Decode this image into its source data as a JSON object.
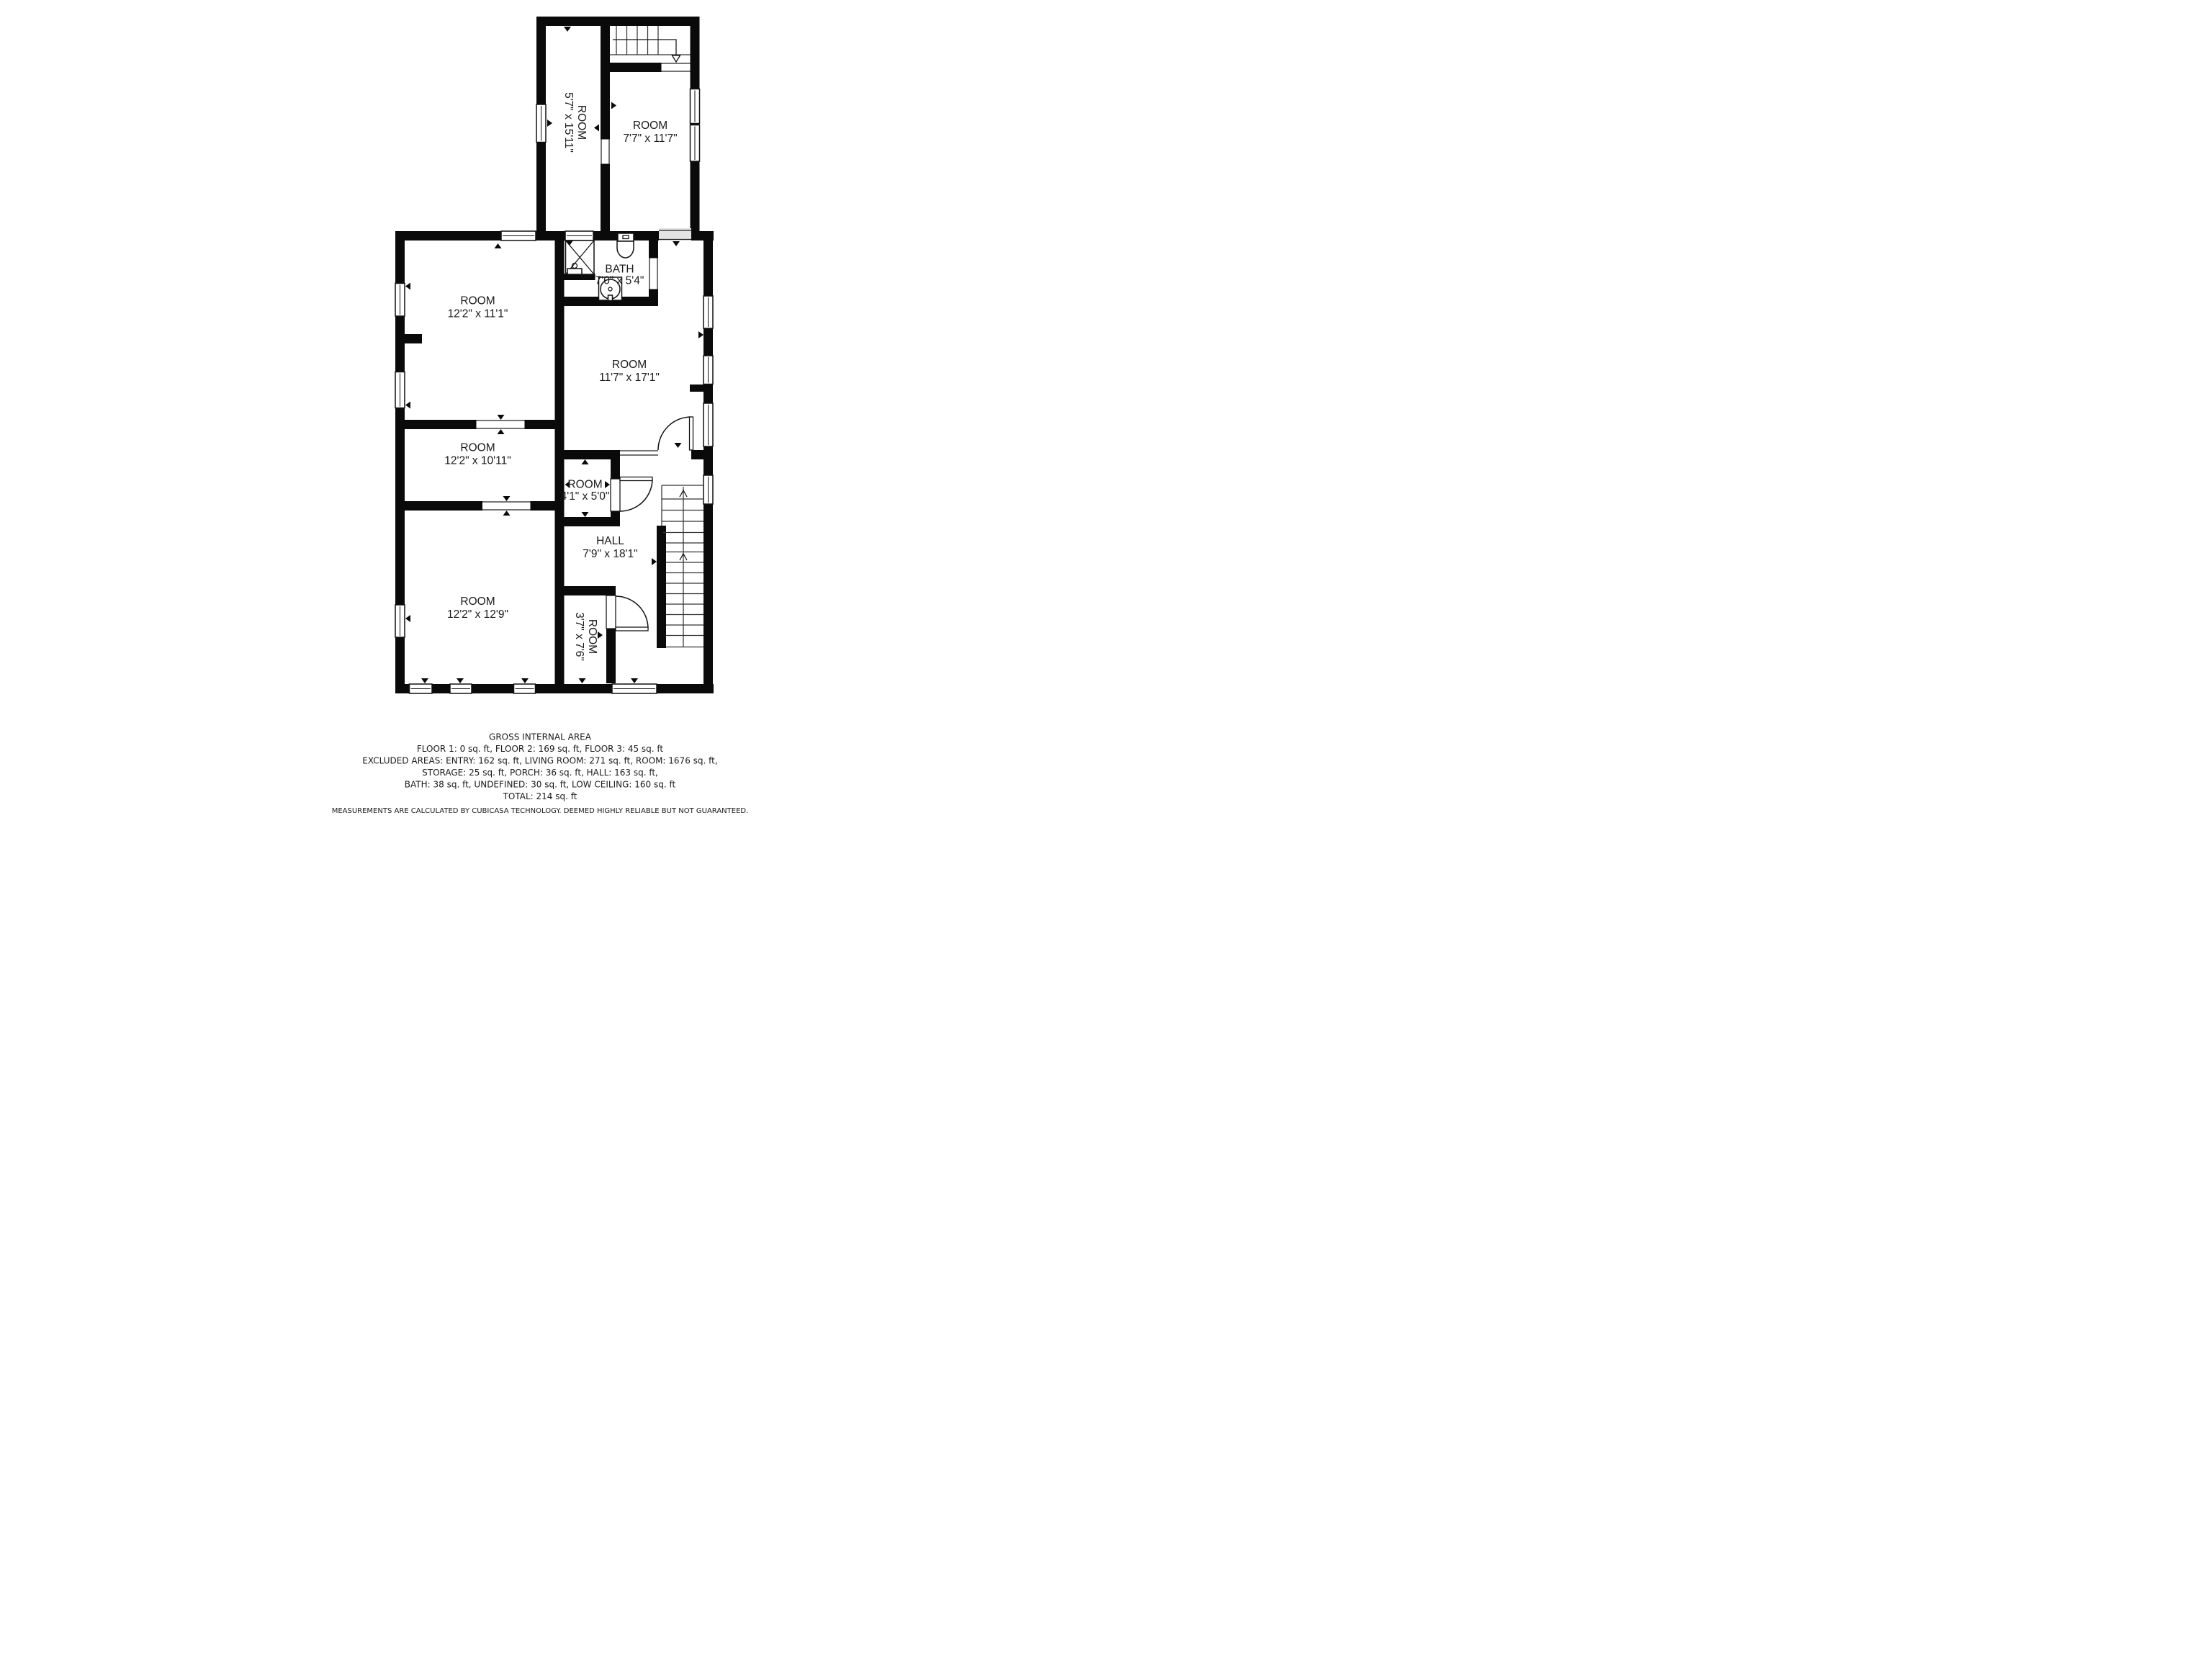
{
  "floorplan": {
    "rooms": [
      {
        "id": "room-top-left",
        "name": "ROOM",
        "dims": "5'7\" x 15'11\""
      },
      {
        "id": "room-top-right",
        "name": "ROOM",
        "dims": "7'7\" x 11'7\""
      },
      {
        "id": "bath",
        "name": "BATH",
        "dims": "7'0\" x 5'4\""
      },
      {
        "id": "room-left-upper",
        "name": "ROOM",
        "dims": "12'2\" x 11'1\""
      },
      {
        "id": "room-right-large",
        "name": "ROOM",
        "dims": "11'7\" x 17'1\""
      },
      {
        "id": "room-left-middle",
        "name": "ROOM",
        "dims": "12'2\" x 10'11\""
      },
      {
        "id": "room-closet",
        "name": "ROOM",
        "dims": "4'1\" x 5'0\""
      },
      {
        "id": "hall",
        "name": "HALL",
        "dims": "7'9\" x 18'1\""
      },
      {
        "id": "room-left-lower",
        "name": "ROOM",
        "dims": "12'2\" x 12'9\""
      },
      {
        "id": "room-small-lower",
        "name": "ROOM",
        "dims": "3'7\" x 7'6\""
      }
    ]
  },
  "footer": {
    "title": "GROSS INTERNAL AREA",
    "line1": "FLOOR 1: 0 sq. ft, FLOOR 2: 169 sq. ft, FLOOR 3: 45 sq. ft",
    "line2": "EXCLUDED AREAS: ENTRY: 162 sq. ft, LIVING ROOM: 271 sq. ft, ROOM: 1676 sq. ft,",
    "line3": "STORAGE: 25 sq. ft, PORCH: 36 sq. ft, HALL: 163 sq. ft,",
    "line4": "BATH: 38 sq. ft, UNDEFINED: 30 sq. ft, LOW CEILING: 160 sq. ft",
    "total": "TOTAL: 214 sq. ft",
    "disclaimer": "MEASUREMENTS ARE CALCULATED BY CUBICASA TECHNOLOGY. DEEMED HIGHLY RELIABLE BUT NOT GUARANTEED."
  }
}
